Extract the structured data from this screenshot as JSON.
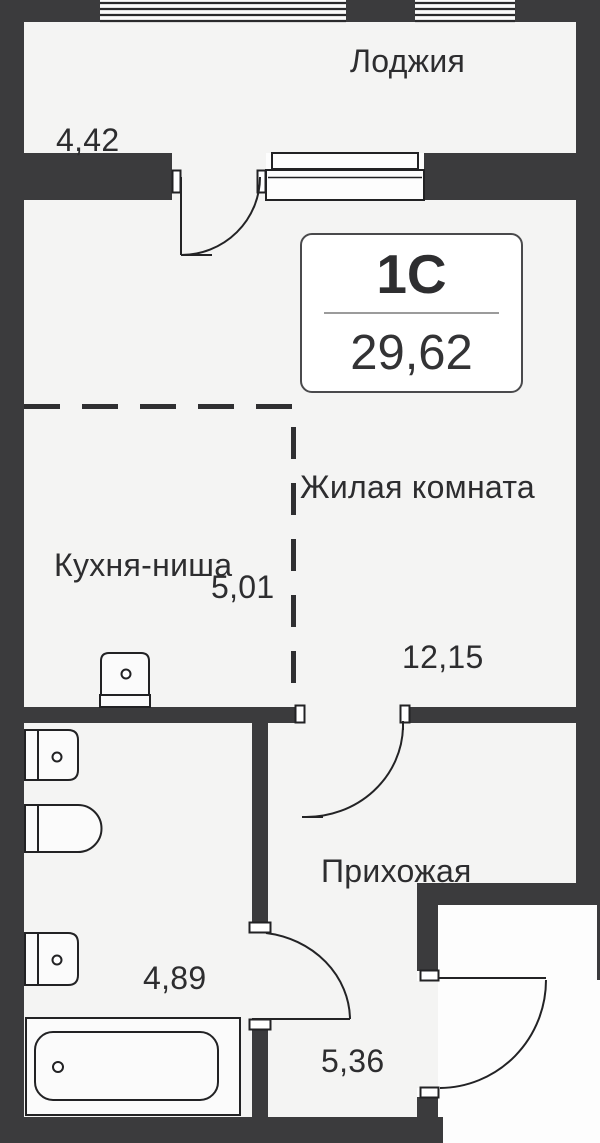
{
  "plan": {
    "unit": {
      "type_label": "1С",
      "total_area": "29,62"
    },
    "rooms": {
      "loggia": {
        "label": "Лоджия",
        "area": "4,42"
      },
      "living_room": {
        "label": "Жилая комната",
        "area": "12,15"
      },
      "kitchen_niche": {
        "label": "Кухня-ниша",
        "area": "5,01"
      },
      "hallway": {
        "label": "Прихожая",
        "area": "5,36"
      },
      "bathroom": {
        "area": "4,89"
      }
    },
    "fixtures": [
      "kitchen-sink",
      "washbasin",
      "toilet",
      "washbasin",
      "bathtub"
    ],
    "colors": {
      "wall": "#3b3b3d",
      "floor": "#f4f4f3",
      "outline": "#222224",
      "unit_box_border": "#4a4a4c",
      "divider_line": "#9b9b9b",
      "text": "#2d2d2f"
    }
  }
}
